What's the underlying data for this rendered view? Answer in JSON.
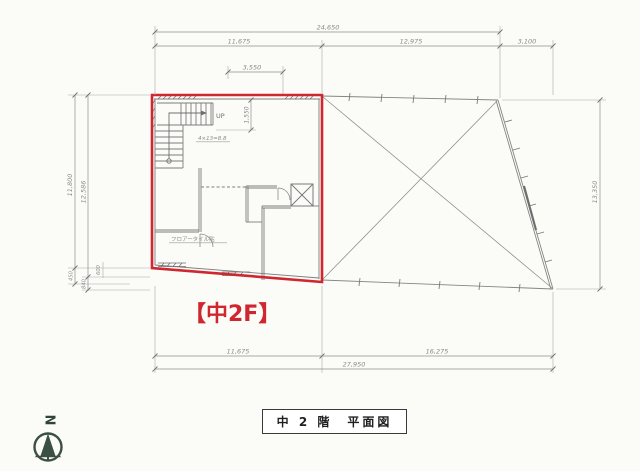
{
  "colors": {
    "highlight_red": "#cf2630",
    "drawing_gray": "#7d7d7d",
    "dimension_gray": "#8f8f8f",
    "compass_green": "#3c4f45"
  },
  "floor_highlight_label": "【中2F】",
  "title_box": {
    "text": "中 2 階　平面図"
  },
  "compass": {
    "label": "N"
  },
  "plan": {
    "up_label": "UP",
    "stair_note": "4×13=8.8",
    "floor_note": "フロアータイル貼"
  },
  "dimensions": {
    "top_total": "24,650",
    "top_seg1": "11,675",
    "top_seg2": "12,975",
    "top_seg3": "3,100",
    "inner_width": "3,550",
    "stair_depth": "1,550",
    "left_outer": "11,800",
    "left_inner": "12,586",
    "left_small_1": "450",
    "left_small_2": "840",
    "left_small_3": "600",
    "right_side": "13,350",
    "bottom_seg1": "11,675",
    "bottom_seg2": "16,275",
    "bottom_total": "27,950"
  }
}
